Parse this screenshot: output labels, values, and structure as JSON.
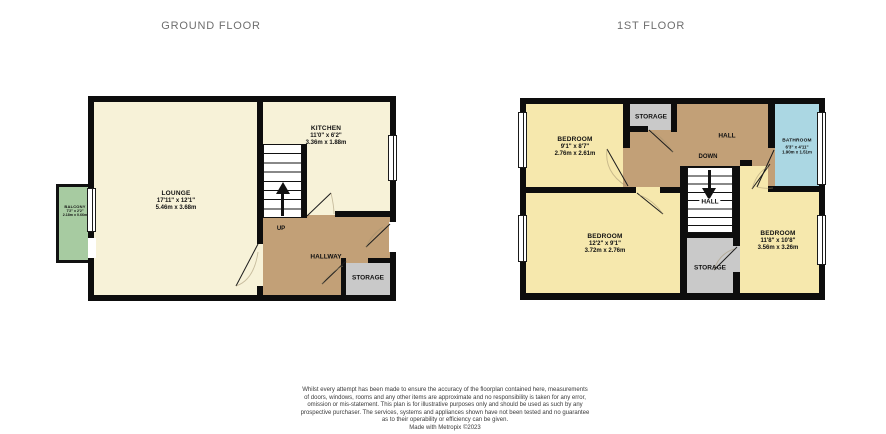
{
  "titles": {
    "ground_floor": "GROUND FLOOR",
    "first_floor": "1ST FLOOR"
  },
  "ground_floor": {
    "lounge": {
      "name": "LOUNGE",
      "size_imperial": "17'11\" x 12'1\"",
      "size_metric": "5.46m x 3.68m"
    },
    "kitchen": {
      "name": "KITCHEN",
      "size_imperial": "11'0\" x 6'2\"",
      "size_metric": "3.36m x 1.88m"
    },
    "hallway": {
      "name": "HALLWAY"
    },
    "storage": {
      "name": "STORAGE"
    },
    "balcony": {
      "name": "BALCONY",
      "size_imperial": "7'2\" x 2'2\"",
      "size_metric": "2.18m x 0.66m"
    },
    "stair_direction": "UP"
  },
  "first_floor": {
    "bedroom_front": {
      "name": "BEDROOM",
      "size_imperial": "9'1\" x 8'7\"",
      "size_metric": "2.76m x 2.61m"
    },
    "bedroom_rear": {
      "name": "BEDROOM",
      "size_imperial": "12'2\" x 9'1\"",
      "size_metric": "3.72m x 2.76m"
    },
    "bedroom_main": {
      "name": "BEDROOM",
      "size_imperial": "11'8\" x 10'8\"",
      "size_metric": "3.56m x 3.26m"
    },
    "bathroom": {
      "name": "BATHROOM",
      "size_imperial": "6'3\" x 4'11\"",
      "size_metric": "1.90m x 1.51m"
    },
    "hall": {
      "name": "HALL"
    },
    "landing": {
      "name": "HALL"
    },
    "storage_top": {
      "name": "STORAGE"
    },
    "storage_bottom": {
      "name": "STORAGE"
    },
    "stair_direction": "DOWN"
  },
  "colors": {
    "wall": "#0d0d0d",
    "room_cream": "#f7f2d8",
    "room_yellow": "#f6e8ad",
    "hall_brown": "#c2a077",
    "storage_grey": "#c9c9c9",
    "bathroom_blue": "#abd7e3",
    "balcony_green": "#a7cba1"
  },
  "disclaimer": {
    "lines": [
      "Whilst every attempt has been made to ensure the accuracy of the floorplan contained here, measurements",
      "of doors, windows, rooms and any other items are approximate and no responsibility is taken for any error,",
      "omission or mis-statement. This plan is for illustrative purposes only and should be used as such by any",
      "prospective purchaser. The services, systems and appliances shown have not been tested and no guarantee",
      "as to their operability or efficiency can be given.",
      "Made with Metropix ©2023"
    ]
  }
}
